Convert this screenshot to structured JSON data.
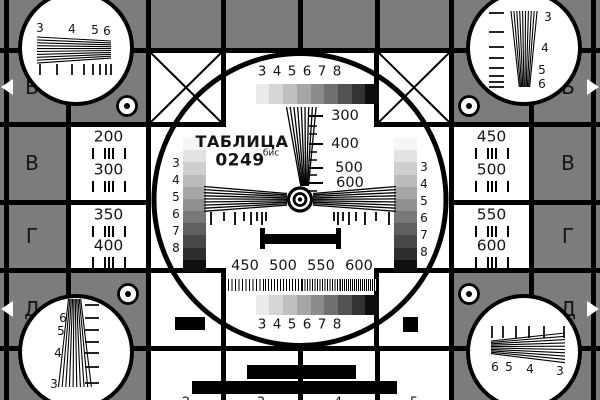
{
  "colors": {
    "background": "#7c7c7c",
    "ink": "#000000",
    "text": "#141414",
    "white": "#ffffff"
  },
  "center": {
    "title": "ТАБЛИЦА",
    "code": "0249",
    "code_sup": "бис",
    "top_scale_labels": [
      "3",
      "4",
      "5",
      "6",
      "7",
      "8"
    ],
    "bottom_scale_labels": [
      "3",
      "4",
      "5",
      "6",
      "7",
      "8"
    ],
    "left_column_labels": [
      "3",
      "4",
      "5",
      "6",
      "7",
      "8"
    ],
    "right_column_labels": [
      "3",
      "4",
      "5",
      "6",
      "7",
      "8"
    ],
    "resolution_scale": [
      "300",
      "400",
      "500",
      "600"
    ],
    "burst_labels": [
      "450",
      "500",
      "550",
      "600"
    ],
    "grayscale_steps": [
      "#ffffff",
      "#eaeaea",
      "#d6d6d6",
      "#bfbfbf",
      "#a6a6a6",
      "#8c8c8c",
      "#707070",
      "#525252",
      "#333333",
      "#0d0d0d"
    ],
    "column_steps": [
      "#f6f6f6",
      "#e3e3e3",
      "#cfcfcf",
      "#bbbbbb",
      "#a6a6a6",
      "#909090",
      "#787878",
      "#606060",
      "#484848",
      "#2e2e2e",
      "#0f0f0f"
    ]
  },
  "side_panels": {
    "left": [
      [
        "200",
        "300"
      ],
      [
        "350",
        "400"
      ]
    ],
    "right": [
      [
        "450",
        "500"
      ],
      [
        "550",
        "600"
      ]
    ]
  },
  "edge_letters_left": [
    "Б",
    "В",
    "Г",
    "Д"
  ],
  "edge_letters_right": [
    "Б",
    "В",
    "Г",
    "Д"
  ],
  "corner_circles": {
    "top_left_labels": [
      "3",
      "4",
      "5",
      "6"
    ],
    "top_right_labels": [
      "3",
      "4",
      "5",
      "6"
    ],
    "bottom_left_labels": [
      "6",
      "5",
      "4",
      "3"
    ],
    "bottom_right_labels": [
      "6",
      "5",
      "4",
      "3"
    ]
  },
  "edge_digits_top": [
    "2",
    "3",
    "4",
    "5"
  ],
  "edge_digits_bottom": [
    "2",
    "3",
    "4",
    "5"
  ]
}
